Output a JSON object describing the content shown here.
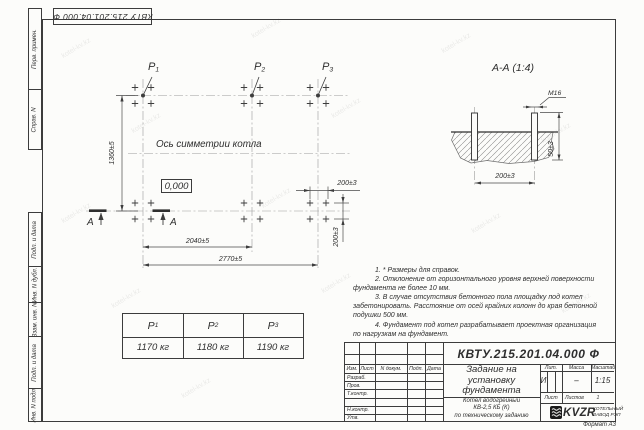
{
  "watermark": "kotel-kv.kz",
  "corner_stamp": "КВТУ 215.201.04.000 Ф",
  "margin": {
    "perv": "Перв. примен.",
    "sprav": "Справ. N",
    "podp1": "Подп. и дата",
    "dubl": "Инв. N дубл.",
    "vzam": "Взам. инв. N",
    "podp2": "Подп. и дата",
    "podl": "Инв. N подл."
  },
  "plan": {
    "p_labels": [
      {
        "base": "P",
        "sub": "1"
      },
      {
        "base": "P",
        "sub": "2"
      },
      {
        "base": "P",
        "sub": "3"
      }
    ],
    "axis_caption": "Ось симметрии котла",
    "level_mark": "0,000",
    "dim_height": "1360±5",
    "dim_span_mid": "2040±5",
    "dim_span_full": "2770±5",
    "dim_bolt_h": "200±3",
    "dim_bolt_v": "200±3",
    "section_letter": "А"
  },
  "section": {
    "title": "А-А (1:4)",
    "thread": "М16",
    "dim_protrusion": "50±3",
    "dim_spacing": "200±3"
  },
  "loads_table": {
    "headers": [
      {
        "base": "P",
        "sub": "1"
      },
      {
        "base": "P",
        "sub": "2"
      },
      {
        "base": "P",
        "sub": "3"
      }
    ],
    "values": [
      "1170 кг",
      "1180 кг",
      "1190 кг"
    ]
  },
  "notes": [
    "1. * Размеры для справок.",
    "2. Отклонение от горизонтального уровня верхней поверхности",
    "фундамента не более 10 мм.",
    "3. В случае отсутствия бетонного пола площадку под котел",
    "забетонировать. Расстояние от осей крайних колонн до края бетонной",
    "подушки 500 мм.",
    "4. Фундамент под котел разрабатывает проектная организация",
    "по нагрузкам на фундамент."
  ],
  "title_block": {
    "designation": "КВТУ.215.201.04.000 Ф",
    "title_lines": [
      "Задание на",
      "установку",
      "фундамента"
    ],
    "product_lines": [
      "Котел водогрейный",
      "КВ-2,5 КБ (К)",
      "по техническому заданию"
    ],
    "col_izm": "Изм.",
    "col_list": "Лист",
    "col_doc": "N докум.",
    "col_podp": "Подп.",
    "col_data": "Дата",
    "row_labels": [
      "Разраб.",
      "Пров.",
      "Т.контр.",
      "",
      "Н.контр.",
      "Утв."
    ],
    "lit_label": "Лит.",
    "mass_label": "Масса",
    "scale_label": "Масштаб",
    "lit_value": "И",
    "mass_value": "–",
    "scale_value": "1:15",
    "sheet_label": "Лист",
    "sheets_label": "Листов",
    "sheets_value": "1",
    "logo_text": "KVZR",
    "logo_line1": "КОТЕЛЬНЫЙ",
    "logo_line2": "ЗАВОД РЭП",
    "format_note": "Формат А3"
  }
}
